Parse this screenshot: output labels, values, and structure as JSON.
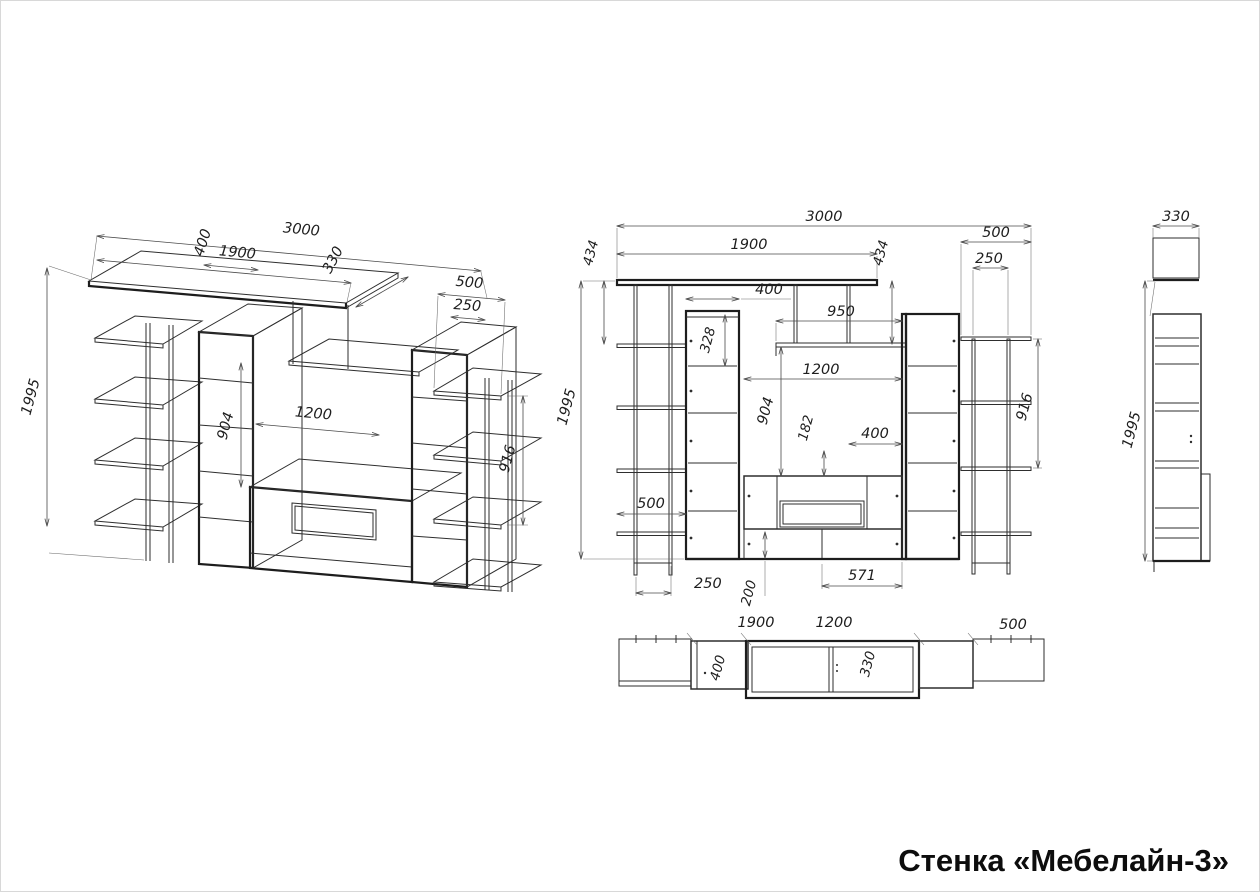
{
  "title": "Стенка «Мебелайн-3»",
  "views": {
    "iso": {
      "labels": {
        "d400": "400",
        "d3000": "3000",
        "d1900": "1900",
        "d330": "330",
        "d500": "500",
        "d250": "250",
        "d1995": "1995",
        "d904": "904",
        "d1200": "1200",
        "d916": "916"
      }
    },
    "front": {
      "labels": {
        "d3000": "3000",
        "d1900": "1900",
        "d434l": "434",
        "d434r": "434",
        "d500top": "500",
        "d250top": "250",
        "d400cab": "400",
        "d950": "950",
        "d328": "328",
        "d1200": "1200",
        "d904": "904",
        "d182": "182",
        "d400tv": "400",
        "d916": "916",
        "d1995": "1995",
        "d500shelf": "500",
        "d250bottom": "250",
        "d200": "200",
        "d571": "571"
      }
    },
    "plan": {
      "labels": {
        "d1900": "1900",
        "d1200": "1200",
        "d500": "500",
        "d400": "400",
        "d330": "330"
      }
    },
    "side": {
      "labels": {
        "d330": "330",
        "d1995": "1995"
      }
    }
  }
}
